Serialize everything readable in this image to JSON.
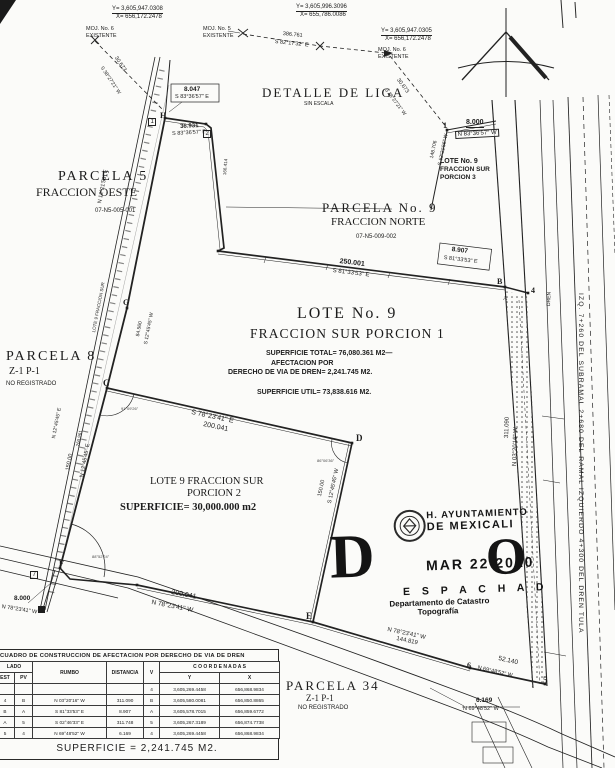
{
  "colors": {
    "ink": "#1c1c1c",
    "paper": "#fbfbf9"
  },
  "stamp": {
    "org_line1": "H. AYUNTAMIENTO",
    "org_line2": "DE MEXICALI",
    "date": "MAR 22 2010",
    "big_d": "D",
    "middle": "E S P A C H A D",
    "big_o": "O",
    "dept1": "Departamento de Catastro",
    "dept2": "Topografía"
  },
  "table": {
    "title": "CUADRO DE CONSTRUCCION DE AFECTACION POR DERECHO DE VIA DE DREN",
    "col_lado": "LADO",
    "col_est": "EST",
    "col_pv": "PV",
    "col_rumbo": "RUMBO",
    "col_distancia": "DISTANCIA",
    "col_v": "V",
    "col_coordenadas": "C O O R D E N A D A S",
    "col_y": "Y",
    "col_x": "X",
    "rows": [
      {
        "est": "",
        "pv": "",
        "rumbo": "",
        "dist": "",
        "v": "4",
        "y": "3,605,269.4458",
        "x": "656,868.9834"
      },
      {
        "est": "4",
        "pv": "B",
        "rumbo": "N 03°20'16\" W",
        "dist": "311.090",
        "v": "B",
        "y": "3,605,580.0081",
        "x": "656,850.8865"
      },
      {
        "est": "B",
        "pv": "A",
        "rumbo": "S 81°33'53\" E",
        "dist": "8.907",
        "v": "A",
        "y": "3,605,578.7015",
        "x": "656,859.6772"
      },
      {
        "est": "A",
        "pv": "5",
        "rumbo": "S 02°46'33\" E",
        "dist": "311.748",
        "v": "5",
        "y": "3,605,267.3189",
        "x": "656,874.7738"
      },
      {
        "est": "5",
        "pv": "4",
        "rumbo": "N 69°48'52\" W",
        "dist": "6.169",
        "v": "4",
        "y": "3,605,269.4458",
        "x": "656,868.9834"
      }
    ],
    "superficie": "SUPERFICIE = 2,241.745 M2."
  },
  "annotations": [
    {
      "t": "Y= 3,605,947.0308",
      "x": 112,
      "y": 6,
      "s": 6,
      "c": "u",
      "n": "mojonera6-left-y"
    },
    {
      "t": "X= 656,172.2478",
      "x": 116,
      "y": 14,
      "s": 6,
      "n": "mojonera6-left-x"
    },
    {
      "t": "MOJ. No. 6",
      "x": 86,
      "y": 27,
      "s": 5.5,
      "n": "mojonera6-left-label"
    },
    {
      "t": "EXISTENTE",
      "x": 86,
      "y": 33.5,
      "s": 5.5
    },
    {
      "t": "Y= 3,605,996.3096",
      "x": 296,
      "y": 4,
      "s": 6,
      "c": "u",
      "n": "mojonera5-y"
    },
    {
      "t": "X= 655,786.0086",
      "x": 300,
      "y": 12,
      "s": 6,
      "n": "mojonera5-x"
    },
    {
      "t": "MOJ. No. 5",
      "x": 203,
      "y": 27,
      "s": 5.5,
      "n": "mojonera5-label"
    },
    {
      "t": "EXISTENTE",
      "x": 203,
      "y": 33.5,
      "s": 5.5
    },
    {
      "t": "386.761",
      "x": 283,
      "y": 32,
      "r": 6,
      "s": 5.5
    },
    {
      "t": "S 82°17'32\" E",
      "x": 275,
      "y": 40,
      "r": 6,
      "s": 5.5
    },
    {
      "t": "Y= 3,605,947.0305",
      "x": 381,
      "y": 28,
      "s": 6,
      "c": "u",
      "n": "mojonera6-right-y"
    },
    {
      "t": "X= 656,172.2478",
      "x": 385,
      "y": 36,
      "s": 6,
      "n": "mojonera6-right-x"
    },
    {
      "t": "MOJ. No. 6",
      "x": 378,
      "y": 48,
      "s": 5.5,
      "n": "mojonera6-right-label"
    },
    {
      "t": "EXISTENTE",
      "x": 378,
      "y": 54.5,
      "s": 5.5
    },
    {
      "t": "30.673",
      "x": 117,
      "y": 56,
      "r": 56,
      "s": 5.5
    },
    {
      "t": "S 38°27'21\" W",
      "x": 103,
      "y": 66,
      "r": 56,
      "s": 5
    },
    {
      "t": "30.673",
      "x": 399,
      "y": 78,
      "r": 53,
      "s": 5.5
    },
    {
      "t": "S 38°27'21\" W",
      "x": 387,
      "y": 88,
      "r": 53,
      "s": 5
    },
    {
      "t": "8.047",
      "x": 184,
      "y": 87,
      "s": 6.5,
      "c": "b"
    },
    {
      "t": "S 83°36'57\" E",
      "x": 175,
      "y": 95,
      "s": 5.5
    },
    {
      "t": "36.931",
      "x": 180,
      "y": 124,
      "r": -3,
      "s": 6,
      "c": "b"
    },
    {
      "t": "S 83°36'57\" E",
      "x": 172,
      "y": 132,
      "r": -3,
      "s": 5.5
    },
    {
      "t": "H",
      "x": 160,
      "y": 112,
      "s": 8,
      "c": "serif b",
      "n": "vertex-h"
    },
    {
      "t": "1",
      "x": 148,
      "y": 118,
      "s": 6,
      "c": "box"
    },
    {
      "t": "2",
      "x": 203,
      "y": 130,
      "s": 6,
      "c": "box",
      "n": "vertex-2"
    },
    {
      "t": "166.414",
      "x": 223,
      "y": 175,
      "r": -85,
      "s": 4.5
    },
    {
      "t": "DETALLE DE LIGA",
      "x": 262,
      "y": 86,
      "s": 13,
      "c": "serif sp",
      "n": "detail-title"
    },
    {
      "t": "SIN ESCALA",
      "x": 304,
      "y": 102,
      "s": 5
    },
    {
      "t": "PARCELA 5",
      "x": 58,
      "y": 170,
      "s": 14,
      "c": "serif sp",
      "n": "parcela5-title"
    },
    {
      "t": "FRACCION OESTE",
      "x": 36,
      "y": 186,
      "s": 12,
      "c": "serif"
    },
    {
      "t": "07-N5-005-001",
      "x": 95,
      "y": 208,
      "s": 6
    },
    {
      "t": "PARCELA No. 9",
      "x": 322,
      "y": 201,
      "s": 13,
      "c": "serif sp",
      "n": "parcela9-title"
    },
    {
      "t": "FRACCION NORTE",
      "x": 331,
      "y": 217,
      "s": 11,
      "c": "serif"
    },
    {
      "t": "07-N5-009-002",
      "x": 356,
      "y": 234,
      "s": 6
    },
    {
      "t": "LOTE No. 9",
      "x": 440,
      "y": 158,
      "s": 7,
      "c": "b",
      "n": "porcion3-title"
    },
    {
      "t": "FRACCION SUR",
      "x": 440,
      "y": 166.5,
      "s": 6.5,
      "c": "b"
    },
    {
      "t": "PORCION 3",
      "x": 440,
      "y": 175,
      "s": 6.5,
      "c": "b"
    },
    {
      "t": "1",
      "x": 443,
      "y": 122,
      "s": 8,
      "c": "serif b",
      "n": "vertex-1"
    },
    {
      "t": "8.000",
      "x": 466,
      "y": 119,
      "s": 7,
      "c": "b u"
    },
    {
      "t": "N 83°36'57\" W",
      "x": 455,
      "y": 131,
      "r": -3,
      "s": 6,
      "c": "box"
    },
    {
      "t": "148.706",
      "x": 430,
      "y": 158,
      "r": -78,
      "s": 5
    },
    {
      "t": "S 12°21'56\" W",
      "x": 438,
      "y": 165,
      "r": -78,
      "s": 5
    },
    {
      "t": "250.001",
      "x": 340,
      "y": 258,
      "r": 7,
      "s": 7,
      "c": "b"
    },
    {
      "t": "S 81°33'53\" E",
      "x": 333,
      "y": 268,
      "r": 7,
      "s": 6
    },
    {
      "t": "8.907",
      "x": 452,
      "y": 247,
      "r": 7,
      "s": 6.5,
      "c": "b"
    },
    {
      "t": "S 81°33'53\" E",
      "x": 444,
      "y": 256,
      "r": 7,
      "s": 5.5
    },
    {
      "t": "B",
      "x": 497,
      "y": 278,
      "s": 8,
      "c": "serif b",
      "n": "vertex-b"
    },
    {
      "t": "A",
      "x": 503,
      "y": 296,
      "s": 6,
      "c": "serif",
      "n": "vertex-a"
    },
    {
      "t": "4",
      "x": 531,
      "y": 287,
      "s": 8,
      "c": "serif b",
      "n": "vertex-4"
    },
    {
      "t": "LOTE No. 9",
      "x": 297,
      "y": 306,
      "s": 16,
      "c": "serif sp",
      "n": "lote9-title"
    },
    {
      "t": "FRACCION SUR PORCION 1",
      "x": 250,
      "y": 327,
      "s": 13.5,
      "c": "serif sp1"
    },
    {
      "t": "SUPERFICIE TOTAL= 76,080.361 M2—",
      "x": 266,
      "y": 350,
      "s": 7,
      "c": "b",
      "n": "superficie-total"
    },
    {
      "t": "AFECTACION POR",
      "x": 271,
      "y": 359.5,
      "s": 7,
      "c": "b"
    },
    {
      "t": "DERECHO DE VIA DE DREN= 2,241.745 M2.",
      "x": 228,
      "y": 369,
      "s": 7,
      "c": "b",
      "n": "afectacion-dren"
    },
    {
      "t": "SUPERFICIE UTIL= 73,838.616 M2.",
      "x": 257,
      "y": 389,
      "s": 7,
      "c": "b",
      "n": "superficie-util"
    },
    {
      "t": "G",
      "x": 123,
      "y": 299,
      "s": 8,
      "c": "serif b",
      "n": "vertex-g"
    },
    {
      "t": "N 12°21'56\" E",
      "x": 98,
      "y": 203,
      "r": -79,
      "s": 5.5
    },
    {
      "t": "LOTE 9 FRACCION SUR",
      "x": 92,
      "y": 332,
      "r": -79,
      "s": 4.5
    },
    {
      "t": "84.560",
      "x": 136,
      "y": 336,
      "r": -79,
      "s": 5
    },
    {
      "t": "S 12°45'45\" W",
      "x": 144,
      "y": 344,
      "r": -79,
      "s": 5
    },
    {
      "t": "C",
      "x": 103,
      "y": 379,
      "s": 9,
      "c": "serif b",
      "n": "vertex-c"
    },
    {
      "t": "91°09'26\"",
      "x": 121,
      "y": 407,
      "s": 4,
      "c": "faint"
    },
    {
      "t": "N 12°45'45\" E",
      "x": 52,
      "y": 438,
      "r": -79,
      "s": 5
    },
    {
      "t": "260.961",
      "x": 76,
      "y": 446,
      "r": -79,
      "s": 4.5
    },
    {
      "t": "150.00",
      "x": 66,
      "y": 470,
      "r": -79,
      "s": 5.5
    },
    {
      "t": "N 12°45'45\" E",
      "x": 80,
      "y": 477,
      "r": -79,
      "s": 5.5
    },
    {
      "t": "S 78°23'41\" E",
      "x": 192,
      "y": 409,
      "r": 12,
      "s": 7
    },
    {
      "t": "200.041",
      "x": 204,
      "y": 421,
      "r": 12,
      "s": 7
    },
    {
      "t": "D",
      "x": 356,
      "y": 434,
      "s": 9,
      "c": "serif b",
      "n": "vertex-d"
    },
    {
      "t": "86°06'36\"",
      "x": 317,
      "y": 459,
      "s": 4,
      "c": "faint"
    },
    {
      "t": "LOTE 9 FRACCION SUR",
      "x": 150,
      "y": 476,
      "s": 10.5,
      "c": "serif",
      "n": "porcion2-title"
    },
    {
      "t": "PORCION 2",
      "x": 187,
      "y": 488,
      "s": 10.5,
      "c": "serif"
    },
    {
      "t": "SUPERFICIE= 30,000.000 m2",
      "x": 120,
      "y": 502,
      "s": 10.5,
      "c": "serif b",
      "n": "porcion2-superficie"
    },
    {
      "t": "150.00",
      "x": 318,
      "y": 496,
      "r": -78,
      "s": 5.5
    },
    {
      "t": "S 12°45'45\" W",
      "x": 328,
      "y": 503,
      "r": -78,
      "s": 5.5
    },
    {
      "t": "E",
      "x": 306,
      "y": 612,
      "s": 9,
      "c": "serif b",
      "n": "vertex-e"
    },
    {
      "t": "F",
      "x": 59,
      "y": 560,
      "s": 8,
      "c": "serif b",
      "n": "vertex-f"
    },
    {
      "t": "7",
      "x": 30,
      "y": 571,
      "s": 6,
      "c": "box",
      "n": "vertex-7"
    },
    {
      "t": "88°52'24\"",
      "x": 92,
      "y": 555,
      "s": 4,
      "c": "faint"
    },
    {
      "t": "8.000",
      "x": 14,
      "y": 596,
      "s": 6.5,
      "c": "b"
    },
    {
      "t": "N 78°23'41\" W",
      "x": 2,
      "y": 605,
      "r": 9,
      "s": 5.5
    },
    {
      "t": "200.041",
      "x": 172,
      "y": 589,
      "r": 11,
      "s": 7
    },
    {
      "t": "N 78°23'41\" W",
      "x": 152,
      "y": 600,
      "r": 11,
      "s": 6.5
    },
    {
      "t": "N 78°23'41\" W",
      "x": 388,
      "y": 627,
      "r": 12,
      "s": 6
    },
    {
      "t": "144.819",
      "x": 397,
      "y": 636,
      "r": 12,
      "s": 6
    },
    {
      "t": "6",
      "x": 467,
      "y": 662,
      "s": 8,
      "c": "serif b",
      "n": "vertex-6"
    },
    {
      "t": "52.140",
      "x": 499,
      "y": 656,
      "r": 13,
      "s": 6.5
    },
    {
      "t": "N 69°48'52\" W",
      "x": 478,
      "y": 666,
      "r": 13,
      "s": 5.5
    },
    {
      "t": "5",
      "x": 543,
      "y": 676,
      "s": 9,
      "c": "serif b",
      "n": "vertex-5"
    },
    {
      "t": "6.169",
      "x": 476,
      "y": 698,
      "s": 6.5,
      "c": "b"
    },
    {
      "t": "N 69°48'52\" W",
      "x": 463,
      "y": 707,
      "s": 5.5
    },
    {
      "t": "311.090",
      "x": 504,
      "y": 438,
      "r": -88,
      "s": 6
    },
    {
      "t": "N 03°20'16\" W",
      "x": 512,
      "y": 466,
      "r": -88,
      "s": 6
    },
    {
      "t": "DREN",
      "x": 547,
      "y": 306,
      "r": -88,
      "s": 5,
      "n": "dren-label"
    },
    {
      "t": "IZQ. 7+260 DEL SUBRAMAL 2+680 DEL RAMAL IZQUIERDO 4+300 DEL DREN TULA",
      "x": 584,
      "y": 293,
      "r": 90,
      "s": 6.8,
      "c": "sp1",
      "n": "dren-station-label"
    },
    {
      "t": "PARCELA 8",
      "x": 6,
      "y": 350,
      "s": 14,
      "c": "serif sp",
      "n": "parcela8-title"
    },
    {
      "t": "Z-1 P-1",
      "x": 9,
      "y": 367,
      "s": 10,
      "c": "serif"
    },
    {
      "t": "NO REGISTRADO",
      "x": 6,
      "y": 381,
      "s": 6
    },
    {
      "t": "PARCELA 34",
      "x": 286,
      "y": 679,
      "s": 13,
      "c": "serif sp",
      "n": "parcela34-title"
    },
    {
      "t": "Z-1 P-1",
      "x": 306,
      "y": 694,
      "s": 9,
      "c": "serif"
    },
    {
      "t": "NO REGISTRADO",
      "x": 298,
      "y": 705,
      "s": 6
    }
  ]
}
